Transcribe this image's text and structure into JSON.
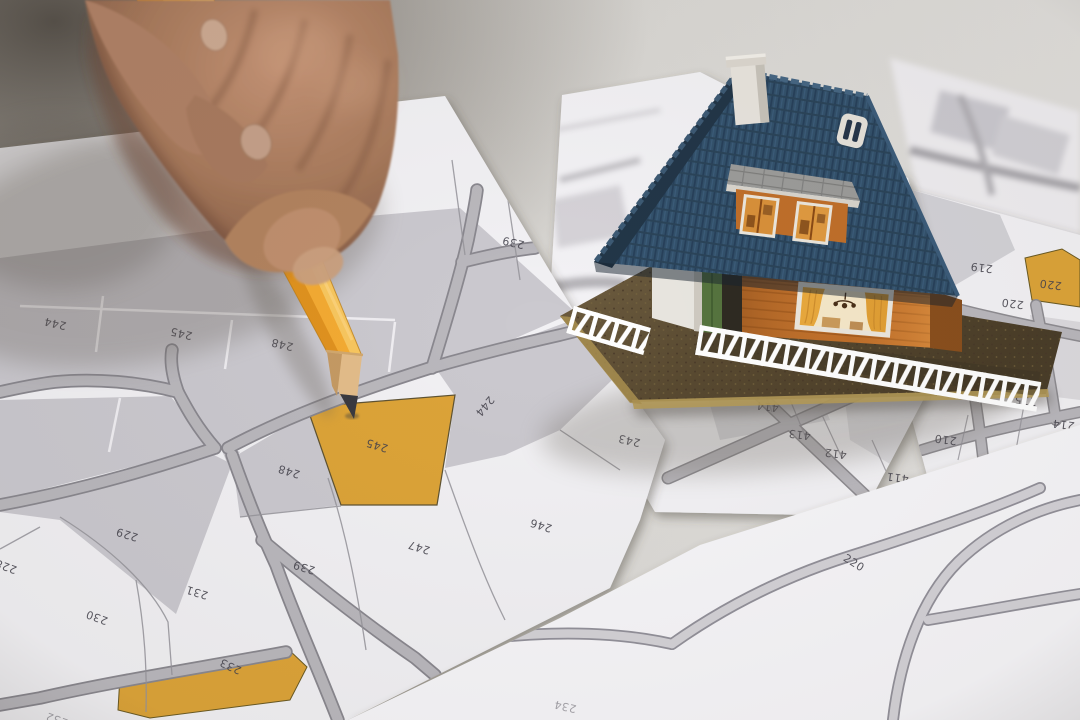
{
  "scene": {
    "type": "photograph",
    "description": "Close-up of a hand pointing with a yellow pencil at an orange-highlighted building parcel on printed cadastral maps; a miniature model house stands on the map sheets.",
    "pointed_parcel": "245"
  },
  "objects": {
    "hand": {
      "label": "hand holding pencil",
      "skin_tone": "#a87c60"
    },
    "pencil": {
      "label": "yellow pencil",
      "body_color": "#f2a93b",
      "wood_color": "#e3bd8a",
      "tip_color": "#3a3a40"
    },
    "house": {
      "label": "model house",
      "roof_color": "#33516b",
      "wall_color": "#c06f2a",
      "trim_color": "#ffffff",
      "base_color": "#5e4e34",
      "fence_color": "#ffffff"
    },
    "maps": {
      "label": "cadastral parcel maps",
      "paper_color": "#f3f2f5",
      "parcel_fill": "#cbc9cf",
      "road_color": "#bab8bd",
      "line_color": "#8f8d92",
      "number_color": "#45434d",
      "highlight_color": "#dda439"
    }
  },
  "sheets": {
    "left": {
      "labels": [
        "244",
        "245",
        "248",
        "239",
        "248",
        "245",
        "244",
        "243",
        "247",
        "246",
        "239",
        "231",
        "230",
        "229",
        "228",
        "233",
        "232"
      ],
      "highlighted": [
        "245",
        "233"
      ]
    },
    "middle": {
      "labels": [
        "258",
        "416",
        "415",
        "414",
        "413",
        "412",
        "411"
      ]
    },
    "right": {
      "labels": [
        "220",
        "219",
        "220",
        "217",
        "216",
        "215",
        "214",
        "212",
        "210",
        "209"
      ],
      "highlighted": [
        "220"
      ]
    },
    "bottom": {
      "labels": [
        "220",
        "234"
      ]
    }
  }
}
